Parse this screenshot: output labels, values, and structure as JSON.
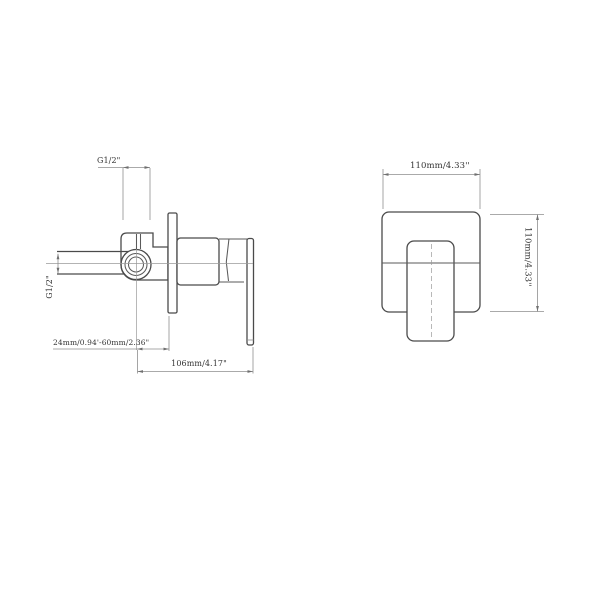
{
  "drawing": {
    "type": "technical-dimension-drawing",
    "subject": "concealed wall-mounted shower mixer valve, side view and front view",
    "colors": {
      "background": "#ffffff",
      "outline": "#4a4a4a",
      "dimension_lines": "#8f8f8f",
      "text": "#333333"
    },
    "side_view": {
      "labels": {
        "top_port_thread": "G1/2\"",
        "inlet_thread": "G1/2\"",
        "wall_depth_range": "24mm/0.94'-60mm/2.36\"",
        "total_depth": "106mm/4.17\""
      }
    },
    "front_view": {
      "labels": {
        "plate_width": "110mm/4.33''",
        "plate_height": "110mm/4.33''"
      }
    }
  }
}
